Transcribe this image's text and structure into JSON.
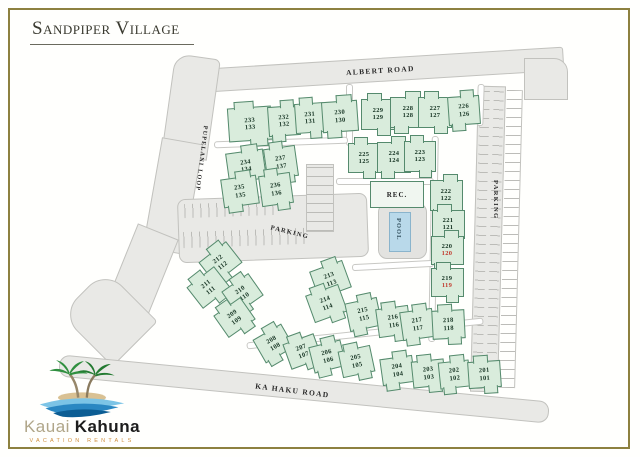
{
  "title": "Sandpiper Village",
  "map": {
    "roads": {
      "albert": {
        "label": "ALBERT ROAD"
      },
      "pupelani": {
        "label": "PUPELANI LOOP"
      },
      "kahaku": {
        "label": "KA HAKU ROAD"
      }
    },
    "parking": {
      "center_label": "PARKING",
      "east_label": "PARKING"
    },
    "facilities": {
      "rec": {
        "label": "REC."
      },
      "pool": {
        "label": "POOL"
      }
    },
    "buildings": [
      {
        "upper": "233",
        "lower": "133",
        "x": 250,
        "y": 124,
        "w": 44,
        "h": 34,
        "rot": -4
      },
      {
        "upper": "232",
        "lower": "132",
        "x": 284,
        "y": 121,
        "w": 32,
        "h": 30,
        "rot": -4
      },
      {
        "upper": "231",
        "lower": "131",
        "x": 310,
        "y": 118,
        "w": 30,
        "h": 30,
        "rot": -4
      },
      {
        "upper": "230",
        "lower": "130",
        "x": 340,
        "y": 116,
        "w": 36,
        "h": 31,
        "rot": -4
      },
      {
        "upper": "229",
        "lower": "129",
        "x": 378,
        "y": 114,
        "w": 34,
        "h": 31,
        "rot": 0
      },
      {
        "upper": "228",
        "lower": "128",
        "x": 408,
        "y": 112,
        "w": 36,
        "h": 31,
        "rot": 0
      },
      {
        "upper": "227",
        "lower": "127",
        "x": 435,
        "y": 112,
        "w": 34,
        "h": 31,
        "rot": 0
      },
      {
        "upper": "226",
        "lower": "126",
        "x": 464,
        "y": 110,
        "w": 32,
        "h": 29,
        "rot": -4
      },
      {
        "upper": "225",
        "lower": "125",
        "x": 364,
        "y": 158,
        "w": 32,
        "h": 30,
        "rot": 0
      },
      {
        "upper": "224",
        "lower": "124",
        "x": 394,
        "y": 157,
        "w": 34,
        "h": 31,
        "rot": 0
      },
      {
        "upper": "223",
        "lower": "123",
        "x": 420,
        "y": 156,
        "w": 32,
        "h": 31,
        "rot": 0
      },
      {
        "upper": "234",
        "lower": "134",
        "x": 246,
        "y": 166,
        "w": 38,
        "h": 30,
        "rot": -8
      },
      {
        "upper": "237",
        "lower": "137",
        "x": 281,
        "y": 162,
        "w": 32,
        "h": 31,
        "rot": -8
      },
      {
        "upper": "235",
        "lower": "135",
        "x": 240,
        "y": 191,
        "w": 36,
        "h": 29,
        "rot": -8
      },
      {
        "upper": "236",
        "lower": "136",
        "x": 276,
        "y": 189,
        "w": 32,
        "h": 31,
        "rot": -8
      },
      {
        "upper": "222",
        "lower": "122",
        "x": 446,
        "y": 195,
        "w": 33,
        "h": 31,
        "rot": 0
      },
      {
        "upper": "221",
        "lower": "121",
        "x": 448,
        "y": 224,
        "w": 33,
        "h": 29,
        "rot": 0
      },
      {
        "upper": "220",
        "lower": "120",
        "x": 447,
        "y": 250,
        "w": 33,
        "h": 29,
        "rot": 0,
        "red": true
      },
      {
        "upper": "219",
        "lower": "119",
        "x": 447,
        "y": 282,
        "w": 33,
        "h": 29,
        "rot": 0,
        "red": true
      },
      {
        "upper": "213",
        "lower": "113",
        "x": 330,
        "y": 279,
        "w": 35,
        "h": 29,
        "rot": -20
      },
      {
        "upper": "214",
        "lower": "114",
        "x": 326,
        "y": 303,
        "w": 35,
        "h": 29,
        "rot": -20
      },
      {
        "upper": "215",
        "lower": "115",
        "x": 363,
        "y": 314,
        "w": 33,
        "h": 29,
        "rot": -12
      },
      {
        "upper": "216",
        "lower": "116",
        "x": 393,
        "y": 321,
        "w": 33,
        "h": 29,
        "rot": -8
      },
      {
        "upper": "217",
        "lower": "117",
        "x": 417,
        "y": 324,
        "w": 33,
        "h": 29,
        "rot": -8
      },
      {
        "upper": "218",
        "lower": "118",
        "x": 448,
        "y": 324,
        "w": 33,
        "h": 29,
        "rot": -3
      },
      {
        "upper": "212",
        "lower": "112",
        "x": 220,
        "y": 262,
        "w": 35,
        "h": 27,
        "rot": -38
      },
      {
        "upper": "211",
        "lower": "111",
        "x": 208,
        "y": 287,
        "w": 35,
        "h": 27,
        "rot": -38
      },
      {
        "upper": "210",
        "lower": "110",
        "x": 242,
        "y": 293,
        "w": 33,
        "h": 27,
        "rot": -35
      },
      {
        "upper": "209",
        "lower": "109",
        "x": 234,
        "y": 317,
        "w": 33,
        "h": 27,
        "rot": -35
      },
      {
        "upper": "208",
        "lower": "108",
        "x": 273,
        "y": 343,
        "w": 33,
        "h": 27,
        "rot": -30
      },
      {
        "upper": "207",
        "lower": "107",
        "x": 302,
        "y": 351,
        "w": 33,
        "h": 27,
        "rot": -20
      },
      {
        "upper": "206",
        "lower": "106",
        "x": 327,
        "y": 356,
        "w": 33,
        "h": 27,
        "rot": -14
      },
      {
        "upper": "205",
        "lower": "105",
        "x": 356,
        "y": 361,
        "w": 33,
        "h": 27,
        "rot": -12
      },
      {
        "upper": "204",
        "lower": "104",
        "x": 397,
        "y": 370,
        "w": 33,
        "h": 27,
        "rot": -8
      },
      {
        "upper": "203",
        "lower": "103",
        "x": 428,
        "y": 373,
        "w": 33,
        "h": 27,
        "rot": -6
      },
      {
        "upper": "202",
        "lower": "102",
        "x": 454,
        "y": 374,
        "w": 31,
        "h": 27,
        "rot": -6
      },
      {
        "upper": "201",
        "lower": "101",
        "x": 484,
        "y": 374,
        "w": 33,
        "h": 27,
        "rot": -4
      }
    ]
  },
  "logo": {
    "brand_first": "Kauai",
    "brand_second": "Kahuna",
    "tagline": "Vacation Rentals"
  },
  "colors": {
    "frame_border": "#8d813f",
    "building_fill": "#d9ecdc",
    "building_outline": "#558a6d",
    "unit_number": "#173524",
    "unit_number_highlight": "#c23b2e",
    "road_fill": "#e9e9e6",
    "pool_water": "#b9d9ea"
  }
}
